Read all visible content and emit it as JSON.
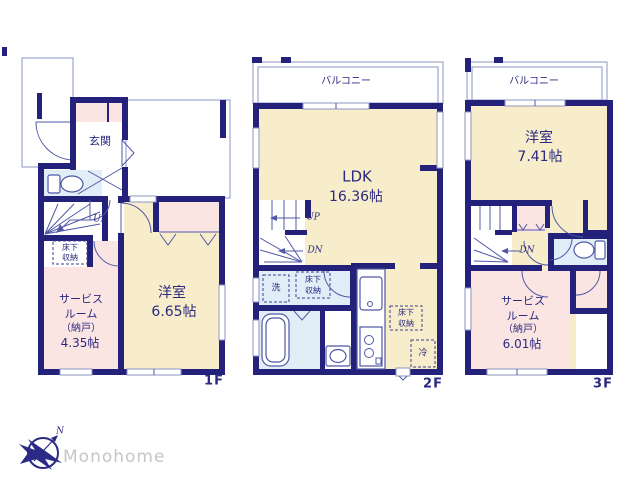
{
  "colors": {
    "wall_navy": "#23217a",
    "room_cream": "#f8edcb",
    "room_pink": "#fbe5e3",
    "room_blue": "#e1eef8",
    "thin_line": "#8d96c2",
    "text_navy": "#2a2980",
    "logo_gray": "#c6c6c6"
  },
  "floors": {
    "f1": {
      "label": "1F",
      "entrance": "玄関",
      "stairs_up": "UP",
      "underfloor": [
        "床下",
        "収納"
      ],
      "service_room": {
        "l1": "サービス",
        "l2": "ルーム",
        "l3": "（納戸）",
        "size": "4.35帖"
      },
      "western_room": {
        "name": "洋室",
        "size": "6.65帖"
      }
    },
    "f2": {
      "label": "2F",
      "balcony": "バルコニー",
      "ldk": {
        "name": "LDK",
        "size": "16.36帖"
      },
      "stairs_up": "UP",
      "stairs_dn": "DN",
      "washer": "洗",
      "underfloor_a": [
        "床下",
        "収納"
      ],
      "underfloor_b": [
        "床下",
        "収納"
      ],
      "fridge": "冷"
    },
    "f3": {
      "label": "3F",
      "balcony": "バルコニー",
      "western_room": {
        "name": "洋室",
        "size": "7.41帖"
      },
      "stairs_dn": "DN",
      "service_room": {
        "l1": "サービス",
        "l2": "ルーム",
        "l3": "（納戸）",
        "size": "6.01帖"
      }
    }
  },
  "logo": {
    "brand": "Monohome",
    "north": "N"
  }
}
